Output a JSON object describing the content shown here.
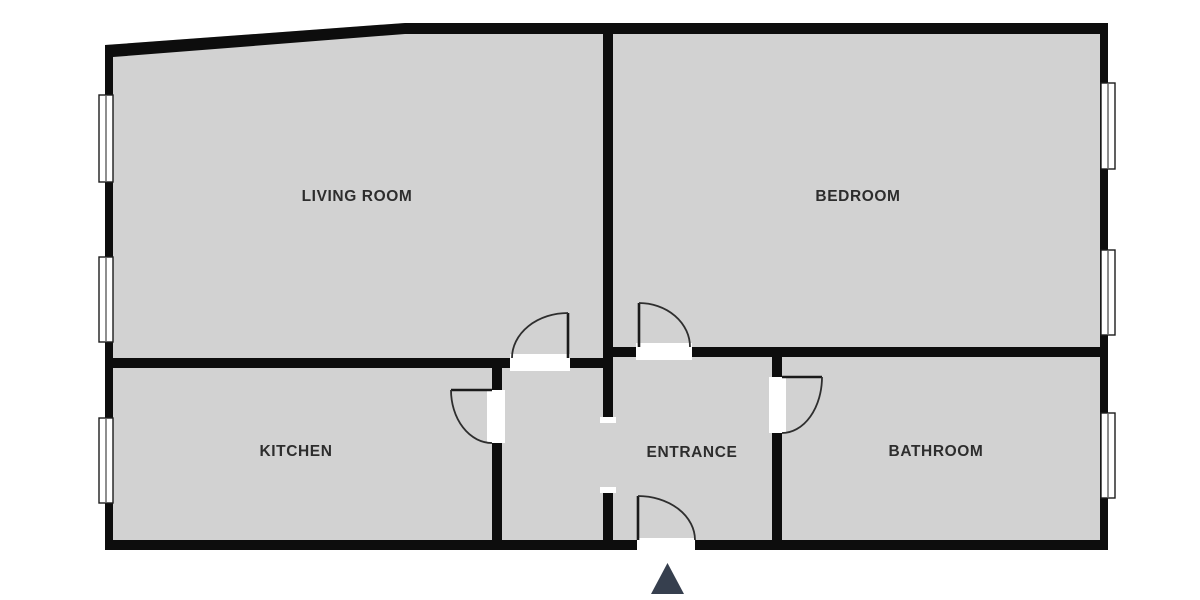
{
  "floorplan": {
    "rooms": [
      {
        "id": "living-room",
        "label": "LIVING ROOM"
      },
      {
        "id": "bedroom",
        "label": "BEDROOM"
      },
      {
        "id": "kitchen",
        "label": "KITCHEN"
      },
      {
        "id": "entrance",
        "label": "ENTRANCE"
      },
      {
        "id": "bathroom",
        "label": "BATHROOM"
      }
    ],
    "colors": {
      "background": "#ffffff",
      "floor": "#d2d2d2",
      "wall": "#0d0d0d",
      "label_text": "#2d2d2d",
      "entrance_arrow": "#363f4e"
    },
    "icons": {
      "entrance_arrow_glyph": "▲"
    }
  }
}
